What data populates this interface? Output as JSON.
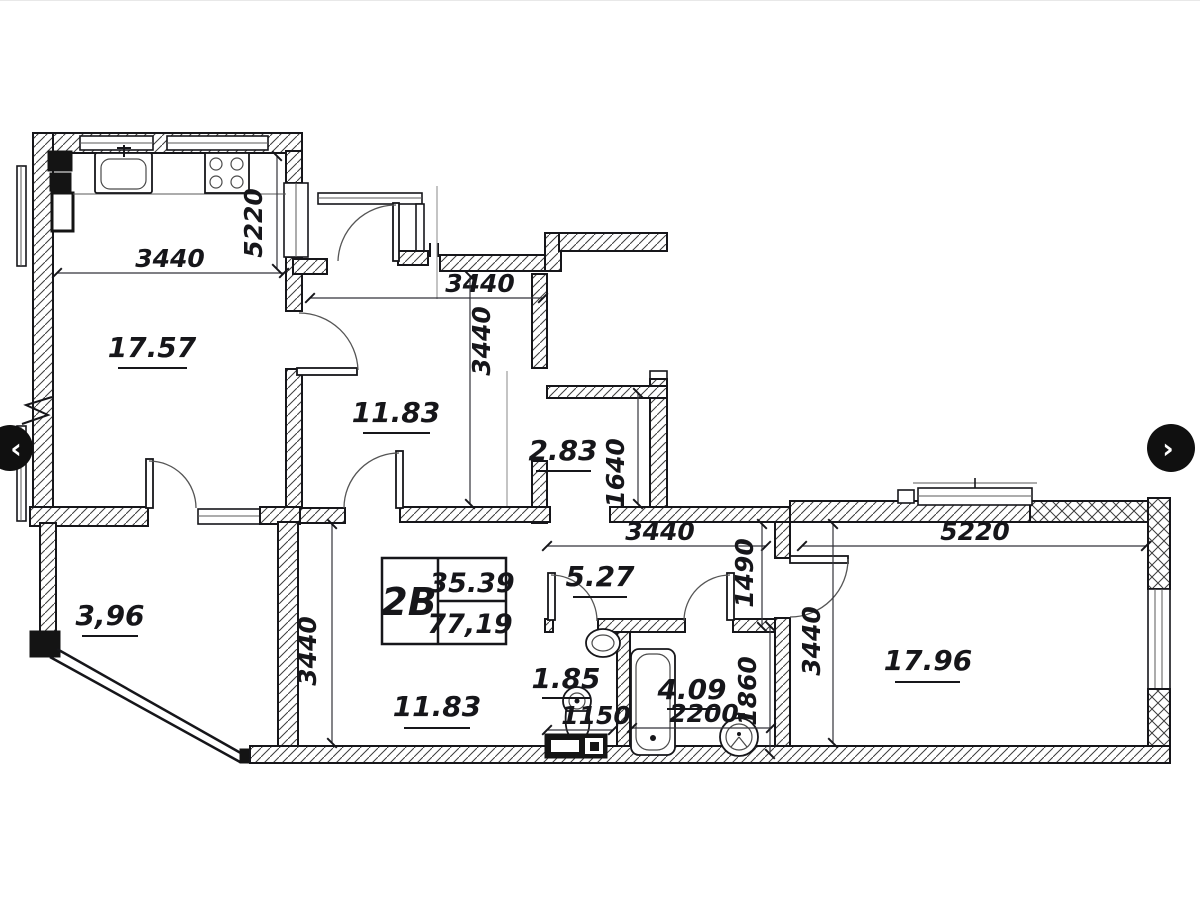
{
  "carousel": {
    "prev": "‹",
    "next": "›"
  },
  "unit_card": {
    "unit": "2B",
    "area_living": "35.39",
    "area_total": "77,19"
  },
  "rooms": {
    "living_kitchen": "17.57",
    "hall_upper": "11.83",
    "corridor": "2.83",
    "balcony": "3,96",
    "room_lower": "11.83",
    "hallway": "5.27",
    "wc": "1.85",
    "bathroom": "4.09",
    "room_right": "17.96"
  },
  "dimensions": {
    "kitchen_width": "3440",
    "kitchen_height": "5220",
    "hall_upper_width": "3440",
    "hall_upper_height": "3440",
    "corridor_length": "1640",
    "hallway_width": "3440",
    "hallway_height": "1490",
    "room_right_width": "5220",
    "room_right_height": "3440",
    "room_lower_height": "3440",
    "wc_width": "1150",
    "bathroom_width": "2200",
    "bathroom_height": "1860"
  },
  "colors": {
    "total_area_red": "#9b2a22",
    "line": "#16161a"
  }
}
